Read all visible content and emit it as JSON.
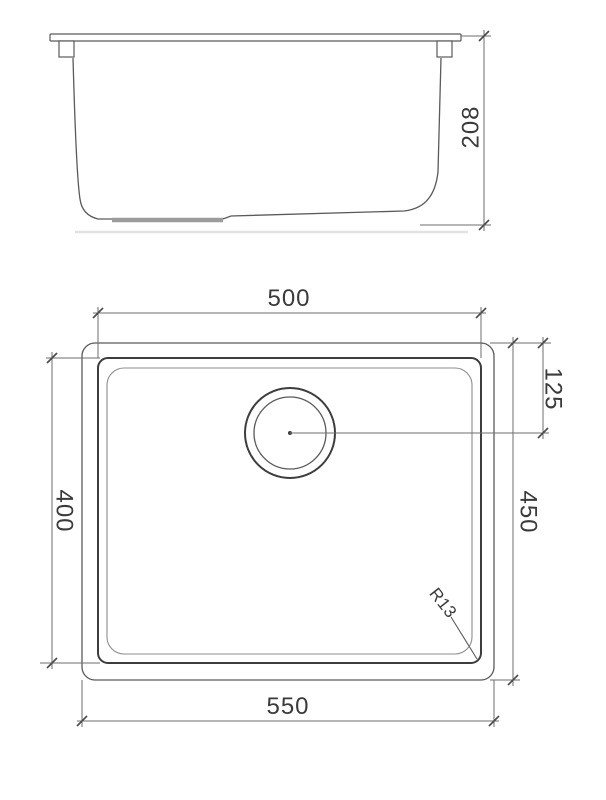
{
  "drawing": {
    "type": "sink-technical-drawing",
    "views": {
      "side": {
        "name": "side-elevation",
        "height_label": "208"
      },
      "plan": {
        "name": "top-plan",
        "inner_width_label": "500",
        "outer_width_label": "550",
        "inner_depth_label": "400",
        "outer_depth_label": "450",
        "drain_offset_label": "125",
        "corner_radius_label": "R13"
      }
    },
    "colors": {
      "background": "#ffffff",
      "object_line": "#5a5a5a",
      "dimension_line": "#6e6e6e",
      "text": "#3a3a3a"
    }
  }
}
